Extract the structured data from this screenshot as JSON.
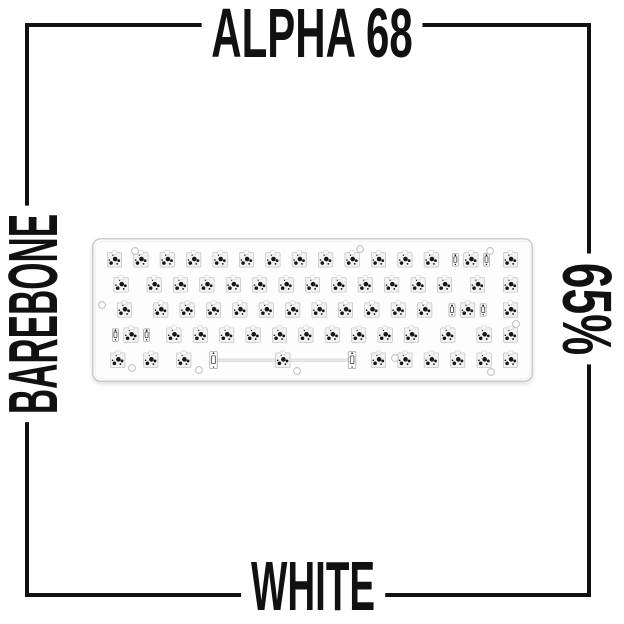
{
  "labels": {
    "top": "ALPHA 68",
    "left": "BAREBONE",
    "right": "65%",
    "bottom": "WHITE"
  },
  "colors": {
    "background": "#ffffff",
    "frame": "#111111",
    "text": "#111111",
    "case_fill": "#fdfdfd",
    "case_border": "#c9c9c9",
    "socket_fill": "#f2f2f2",
    "socket_border": "#b9b9b9",
    "notch_fill": "#fafafa",
    "notch_border": "#c9c9c9",
    "dot": "#161616",
    "stab_fill": "#ffffff",
    "stab_border": "#a8a8a8",
    "stab_detail": "#3a443a",
    "wire_fill": "#e9e9e9",
    "wire_border": "#c6c6c6",
    "screw_border": "#c2c2c2"
  },
  "keyboard": {
    "description": "barebone hotswap 65% keyboard, white case, no switches or keycaps, 68 sockets, stabilizers preinstalled",
    "unit": 26.4,
    "width": 441,
    "height": 144,
    "rows": [
      [
        1,
        1,
        1,
        1,
        1,
        1,
        1,
        1,
        1,
        1,
        1,
        1,
        1,
        2,
        1
      ],
      [
        1.5,
        1,
        1,
        1,
        1,
        1,
        1,
        1,
        1,
        1,
        1,
        1,
        1,
        1.5,
        1
      ],
      [
        1.75,
        1,
        1,
        1,
        1,
        1,
        1,
        1,
        1,
        1,
        1,
        1,
        2.25,
        1
      ],
      [
        2.25,
        1,
        1,
        1,
        1,
        1,
        1,
        1,
        1,
        1,
        1,
        1.75,
        1,
        1
      ],
      [
        1.25,
        1.25,
        1.25,
        6.25,
        1,
        1,
        1,
        1,
        1,
        1
      ]
    ],
    "screw_holes": [
      [
        43,
        13
      ],
      [
        268,
        11
      ],
      [
        398,
        13
      ],
      [
        10,
        67
      ],
      [
        424,
        86
      ],
      [
        40,
        130
      ],
      [
        107,
        132
      ],
      [
        205,
        133
      ],
      [
        303,
        120
      ],
      [
        399,
        134
      ]
    ]
  }
}
